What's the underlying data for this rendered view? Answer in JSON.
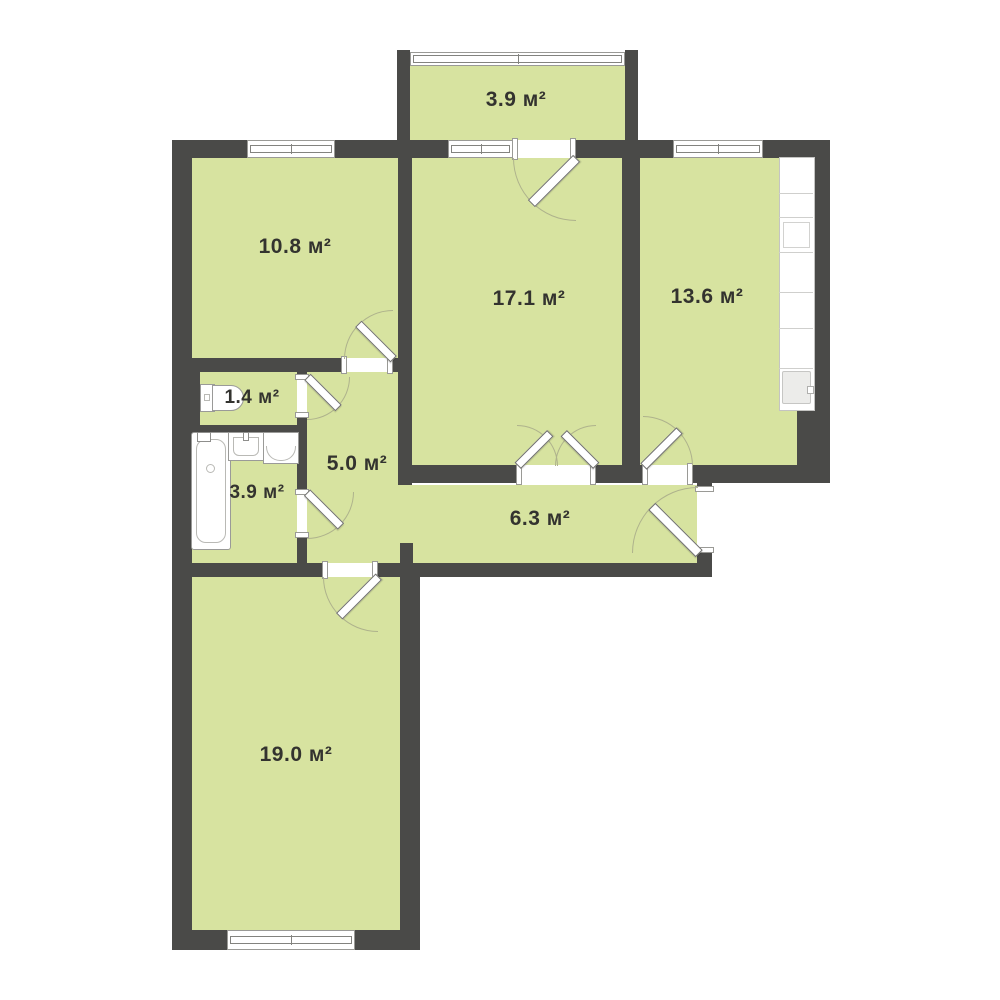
{
  "plan": {
    "title": "apartment-floor-plan",
    "unit": "м²",
    "colors": {
      "wall": "#4a4a48",
      "floor": "#d7e3a0",
      "background": "#ffffff",
      "door_arc": "#aeb28c"
    },
    "rooms": [
      {
        "name": "balcony",
        "area_label": "3.9 м²"
      },
      {
        "name": "bedroom-1",
        "area_label": "10.8 м²"
      },
      {
        "name": "living-room",
        "area_label": "17.1 м²"
      },
      {
        "name": "kitchen",
        "area_label": "13.6 м²"
      },
      {
        "name": "wc",
        "area_label": "1.4 м²"
      },
      {
        "name": "hallway",
        "area_label": "5.0 м²"
      },
      {
        "name": "bathroom",
        "area_label": "3.9 м²"
      },
      {
        "name": "corridor",
        "area_label": "6.3 м²"
      },
      {
        "name": "bedroom-2",
        "area_label": "19.0 м²"
      }
    ],
    "fixtures": [
      "toilet",
      "bathtub",
      "bath-sink",
      "washing-machine",
      "kitchen-counter",
      "kitchen-sink"
    ]
  }
}
